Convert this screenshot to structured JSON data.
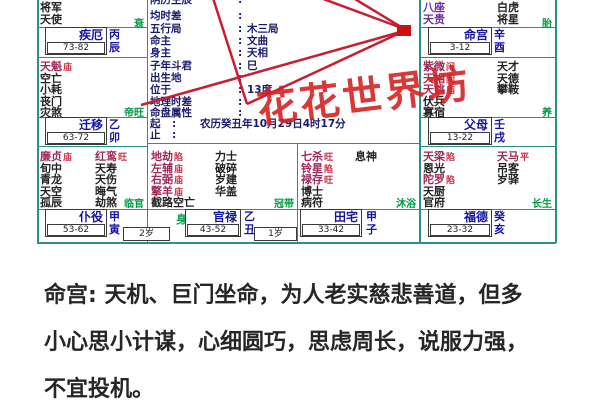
{
  "chart": {
    "watermark": "花花世界坊",
    "center_info": {
      "rows": [
        {
          "label": "阴历生辰",
          "value": "",
          "long": false
        },
        {
          "label": "均时差",
          "value": "",
          "long": false
        },
        {
          "label": "五行局",
          "value": "木三局",
          "long": false
        },
        {
          "label": "命主",
          "value": "文曲",
          "long": false
        },
        {
          "label": "身主",
          "value": "天相",
          "long": false
        },
        {
          "label": "子年斗君",
          "value": "巳",
          "long": false
        },
        {
          "label": "出生地",
          "value": "",
          "long": false
        },
        {
          "label": "位于",
          "value": "13度",
          "long": false
        },
        {
          "label": "地理时差",
          "value": "",
          "long": false
        },
        {
          "label": "命盘属性",
          "value": "",
          "long": false
        },
        {
          "label": "起",
          "value": "农历癸丑年10月29日4时17分",
          "long": true
        },
        {
          "label": "止",
          "value": "",
          "long": true
        }
      ]
    },
    "palaces": [
      {
        "id": "chen",
        "name": "疾厄",
        "stem": "丙",
        "branch": "辰",
        "age_range": "73-82",
        "stage": "衰",
        "stars_a": [
          {
            "name": "将军"
          },
          {
            "name": "天使"
          }
        ],
        "stars_b": []
      },
      {
        "id": "you",
        "name": "命宫",
        "stem": "辛",
        "branch": "酉",
        "age_range": "3-12",
        "stage": "胎",
        "stars_a": [
          {
            "name": "八座",
            "color": "purple"
          },
          {
            "name": "天贵",
            "color": "purple"
          }
        ],
        "stars_b": [
          {
            "name": "白虎"
          },
          {
            "name": "将星"
          }
        ]
      },
      {
        "id": "mao",
        "name": "迁移",
        "stem": "乙",
        "branch": "卯",
        "age_range": "63-72",
        "stage": "帝旺",
        "stars_a": [
          {
            "name": "天魁",
            "rating": "庙",
            "color": "major"
          },
          {
            "name": "空亡"
          },
          {
            "name": "小耗"
          },
          {
            "name": "丧门"
          },
          {
            "name": "灾煞"
          }
        ],
        "stars_b": []
      },
      {
        "id": "xu",
        "name": "父母",
        "stem": "壬",
        "branch": "戌",
        "age_range": "13-22",
        "stage": "养",
        "stars_a": [
          {
            "name": "紫微",
            "rating": "闲",
            "color": "major"
          },
          {
            "name": "天相",
            "rating": "闲",
            "color": "major"
          },
          {
            "name": "天姚",
            "rating": "庙",
            "color": "major"
          },
          {
            "name": "伏兵"
          },
          {
            "name": "寡宿"
          }
        ],
        "stars_b": [
          {
            "name": "天才"
          },
          {
            "name": "天德"
          },
          {
            "name": "攀鞍"
          }
        ]
      },
      {
        "id": "yin",
        "name": "仆役",
        "stem": "甲",
        "branch": "寅",
        "age_range": "53-62",
        "year_age": "2岁",
        "stage": "临官",
        "stars_a": [
          {
            "name": "廉贞",
            "rating": "庙",
            "color": "major"
          },
          {
            "name": "旬中"
          },
          {
            "name": "青龙"
          },
          {
            "name": "天空"
          },
          {
            "name": "孤辰"
          }
        ],
        "stars_b": [
          {
            "name": "红鸾",
            "rating": "旺",
            "color": "major"
          },
          {
            "name": "天寿"
          },
          {
            "name": "天伤"
          },
          {
            "name": "晦气"
          },
          {
            "name": "劫煞"
          }
        ]
      },
      {
        "id": "chou",
        "name": "官禄",
        "stem": "乙",
        "branch": "丑",
        "age_range": "43-52",
        "year_age": "1岁",
        "body_marker": "身",
        "stage": "冠带",
        "stars_a": [
          {
            "name": "地劫",
            "rating": "陷",
            "color": "major"
          },
          {
            "name": "左辅",
            "rating": "庙",
            "color": "major"
          },
          {
            "name": "右弼",
            "rating": "庙",
            "color": "major"
          },
          {
            "name": "擎羊",
            "rating": "庙",
            "color": "major"
          },
          {
            "name": "截路空亡"
          }
        ],
        "stars_b": [
          {
            "name": "力士"
          },
          {
            "name": "破碎"
          },
          {
            "name": "岁建"
          },
          {
            "name": "华盖"
          }
        ]
      },
      {
        "id": "zi",
        "name": "田宅",
        "stem": "甲",
        "branch": "子",
        "age_range": "33-42",
        "stage": "沐浴",
        "stars_a": [
          {
            "name": "七杀",
            "rating": "旺",
            "color": "major"
          },
          {
            "name": "铃星",
            "rating": "陷",
            "color": "major"
          },
          {
            "name": "禄存",
            "rating": "旺",
            "color": "major"
          },
          {
            "name": "博士"
          },
          {
            "name": "病符"
          }
        ],
        "stars_b": [
          {
            "name": "息神"
          }
        ]
      },
      {
        "id": "hai",
        "name": "福德",
        "stem": "癸",
        "branch": "亥",
        "age_range": "23-32",
        "stage": "长生",
        "stars_a": [
          {
            "name": "天梁",
            "rating": "陷",
            "color": "major"
          },
          {
            "name": "恩光"
          },
          {
            "name": "陀罗",
            "rating": "陷",
            "color": "major"
          },
          {
            "name": "天厨"
          },
          {
            "name": "官府"
          }
        ],
        "stars_b": [
          {
            "name": "天马",
            "rating": "平",
            "color": "major"
          },
          {
            "name": "吊客"
          },
          {
            "name": "岁驿"
          }
        ]
      }
    ]
  },
  "reading": {
    "lines": [
      "命宫: 天机、巨门坐命，为人老实慈悲善道，但多",
      "小心思小计谋，心细圆巧，思虑周长，说服力强，",
      "不宜投机。"
    ]
  },
  "colors": {
    "grid": "#2a8f8f",
    "palace_name": "#1414a0",
    "major_star": "#a02858",
    "minor_star": "#222222",
    "purple_star": "#7030a0",
    "rating": "#cc3344",
    "stage_green": "#009944",
    "watermark_red": "#d42222",
    "line_red": "#c81e32"
  }
}
